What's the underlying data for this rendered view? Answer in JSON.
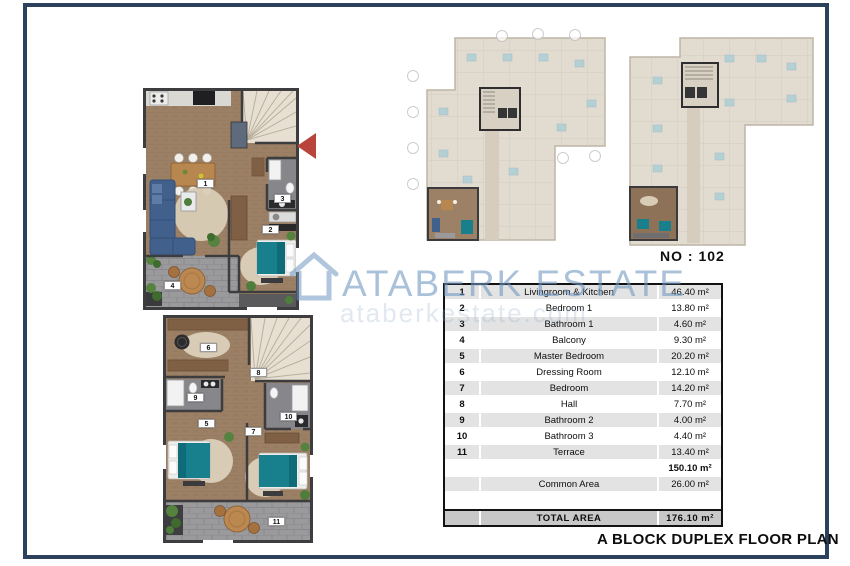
{
  "watermark": {
    "brand": "ATABERK ESTATE",
    "url": "ataberkestate.com",
    "icon": "house-icon"
  },
  "unit_label": "NO : 102",
  "caption": "A BLOCK DUPLEX FLOOR PLAN",
  "plans": {
    "lower_floor": {
      "labels": [
        "1",
        "2",
        "3",
        "4"
      ]
    },
    "upper_floor": {
      "labels": [
        "5",
        "6",
        "7",
        "8",
        "9",
        "10",
        "11"
      ]
    }
  },
  "area_table": {
    "rows": [
      {
        "no": "1",
        "room": "Livingroom & Kitchen",
        "area": "46.40 m²"
      },
      {
        "no": "2",
        "room": "Bedroom 1",
        "area": "13.80 m²"
      },
      {
        "no": "3",
        "room": "Bathroom 1",
        "area": "4.60 m²"
      },
      {
        "no": "4",
        "room": "Balcony",
        "area": "9.30 m²"
      },
      {
        "no": "5",
        "room": "Master Bedroom",
        "area": "20.20 m²"
      },
      {
        "no": "6",
        "room": "Dressing Room",
        "area": "12.10 m²"
      },
      {
        "no": "7",
        "room": "Bedroom",
        "area": "14.20 m²"
      },
      {
        "no": "8",
        "room": "Hall",
        "area": "7.70 m²"
      },
      {
        "no": "9",
        "room": "Bathroom 2",
        "area": "4.00 m²"
      },
      {
        "no": "10",
        "room": "Bathroom 3",
        "area": "4.40 m²"
      },
      {
        "no": "11",
        "room": "Terrace",
        "area": "13.40 m²"
      },
      {
        "no": "",
        "room": "",
        "area": "150.10 m²"
      },
      {
        "no": "",
        "room": "Common Area",
        "area": "26.00 m²"
      },
      {
        "no": "",
        "room": "",
        "area": ""
      },
      {
        "no": "",
        "room": "TOTAL AREA",
        "area": "176.10 m²"
      }
    ]
  },
  "colors": {
    "frame_navy": "#2b415c",
    "watermark_blue": "#7198c1",
    "arrow_red": "#b9443c",
    "wood_floor": "#9c8065",
    "bed_teal": "#17808c",
    "sofa_blue": "#41608c",
    "row_gray": "#e3e3e3",
    "total_gray": "#c8c8c8"
  }
}
